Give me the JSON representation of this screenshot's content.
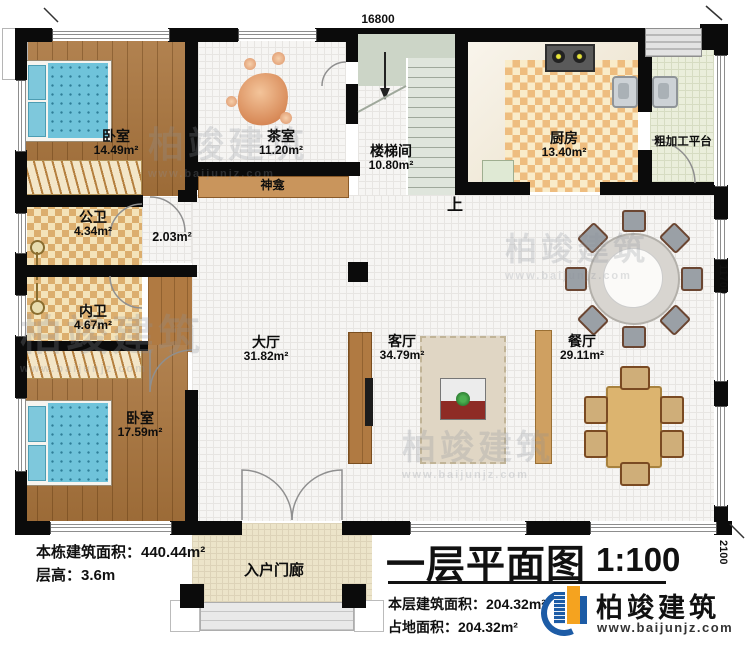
{
  "rooms": {
    "bedroom1": {
      "name": "卧室",
      "area": "14.49m²"
    },
    "tea": {
      "name": "茶室",
      "area": "11.20m²"
    },
    "shrine": {
      "name": "神龛"
    },
    "stair": {
      "name": "楼梯间",
      "area": "10.80m²",
      "up": "上"
    },
    "kitchen": {
      "name": "厨房",
      "area": "13.40m²"
    },
    "platform": {
      "name": "粗加工平台"
    },
    "bath_public": {
      "name": "公卫",
      "area": "4.34m²"
    },
    "corridor": {
      "area": "2.03m²"
    },
    "bath_inner": {
      "name": "内卫",
      "area": "4.67m²"
    },
    "bedroom2": {
      "name": "卧室",
      "area": "17.59m²"
    },
    "hall": {
      "name": "大厅",
      "area": "31.82m²"
    },
    "living": {
      "name": "客厅",
      "area": "34.79m²"
    },
    "dining": {
      "name": "餐厅",
      "area": "29.11m²"
    },
    "porch": {
      "name": "入户门廊"
    }
  },
  "dimensions": {
    "top": "16800",
    "right": "11700",
    "right_lower": "2100"
  },
  "info": {
    "building_area": "本栋建筑面积：440.44m²",
    "floor_height": "层高：3.6m",
    "title": "一层平面图",
    "scale": "1:100",
    "floor_area": "本层建筑面积：204.32m²",
    "ground_area": "占地面积：204.32m²"
  },
  "brand": {
    "name": "柏竣建筑",
    "url": "www.baijunjz.com"
  },
  "watermark": {
    "name": "柏竣建筑",
    "url": "www.baijunjz.com"
  },
  "colors": {
    "brand_blue": "#1d5ca6",
    "brand_orange": "#f5a31f",
    "wall": "#0b0b0b",
    "wood": "#a9743c",
    "accent_red": "#7c2022"
  }
}
